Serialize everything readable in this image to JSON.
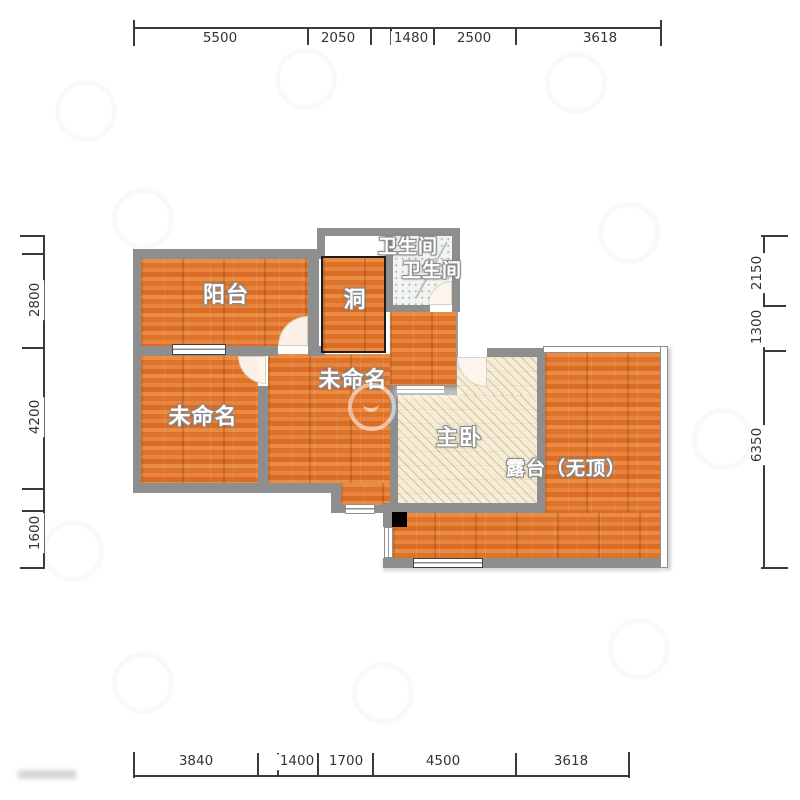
{
  "page": {
    "type": "apartment-floor-plan"
  },
  "colors": {
    "wood_floor": "#e0762f",
    "wall": "#8e8e8e",
    "hatch_floor": "#f6edd6",
    "tile_floor": "#f2f4f1",
    "hole_border": "#1c1c1c",
    "column": "#000000",
    "dimension_text": "#333333",
    "label_text": "#ffffff"
  },
  "rooms": [
    {
      "id": "balcony",
      "label": "阳台"
    },
    {
      "id": "hole",
      "label": "洞"
    },
    {
      "id": "bathroom-1",
      "label": "卫生间"
    },
    {
      "id": "bathroom-2",
      "label": "卫生间"
    },
    {
      "id": "unnamed-left",
      "label": "未命名"
    },
    {
      "id": "unnamed-middle",
      "label": "未命名"
    },
    {
      "id": "master-bedroom",
      "label": "主卧"
    },
    {
      "id": "terrace",
      "label": "露台（无顶）"
    }
  ],
  "dimensions": {
    "top": {
      "labels": [
        "5500",
        "2050",
        "1480",
        "2500",
        "3618"
      ]
    },
    "bottom": {
      "labels": [
        "3840",
        "1400",
        "1700",
        "4500",
        "3618"
      ]
    },
    "left": {
      "labels": [
        "2800",
        "4200",
        "1600"
      ]
    },
    "right": {
      "labels": [
        "2150",
        "1300",
        "6350"
      ]
    }
  }
}
